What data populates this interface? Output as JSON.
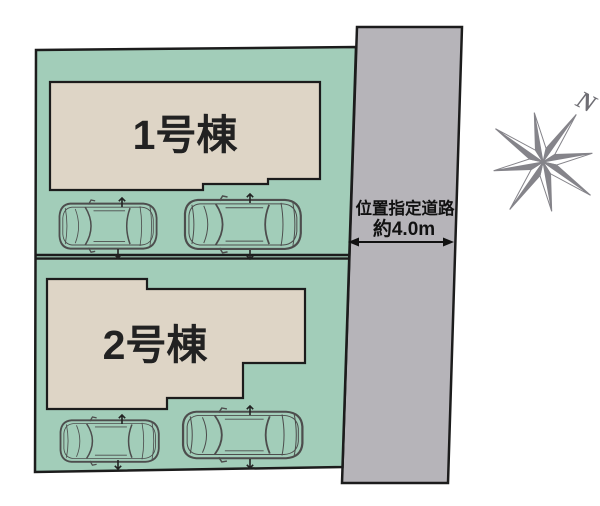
{
  "diagram": {
    "lot1": {
      "building_label": "1号棟"
    },
    "lot2": {
      "building_label": "2号棟"
    },
    "road": {
      "label_line1": "位置指定道路",
      "label_line2": "約4.0m"
    },
    "compass": {
      "north_label": "N"
    },
    "colors": {
      "lot_fill": "#a2cdb9",
      "building_fill": "#ded5c6",
      "road_fill": "#b6b4b9",
      "outline": "#1c1c1c",
      "compass_gray": "#85848a"
    }
  }
}
